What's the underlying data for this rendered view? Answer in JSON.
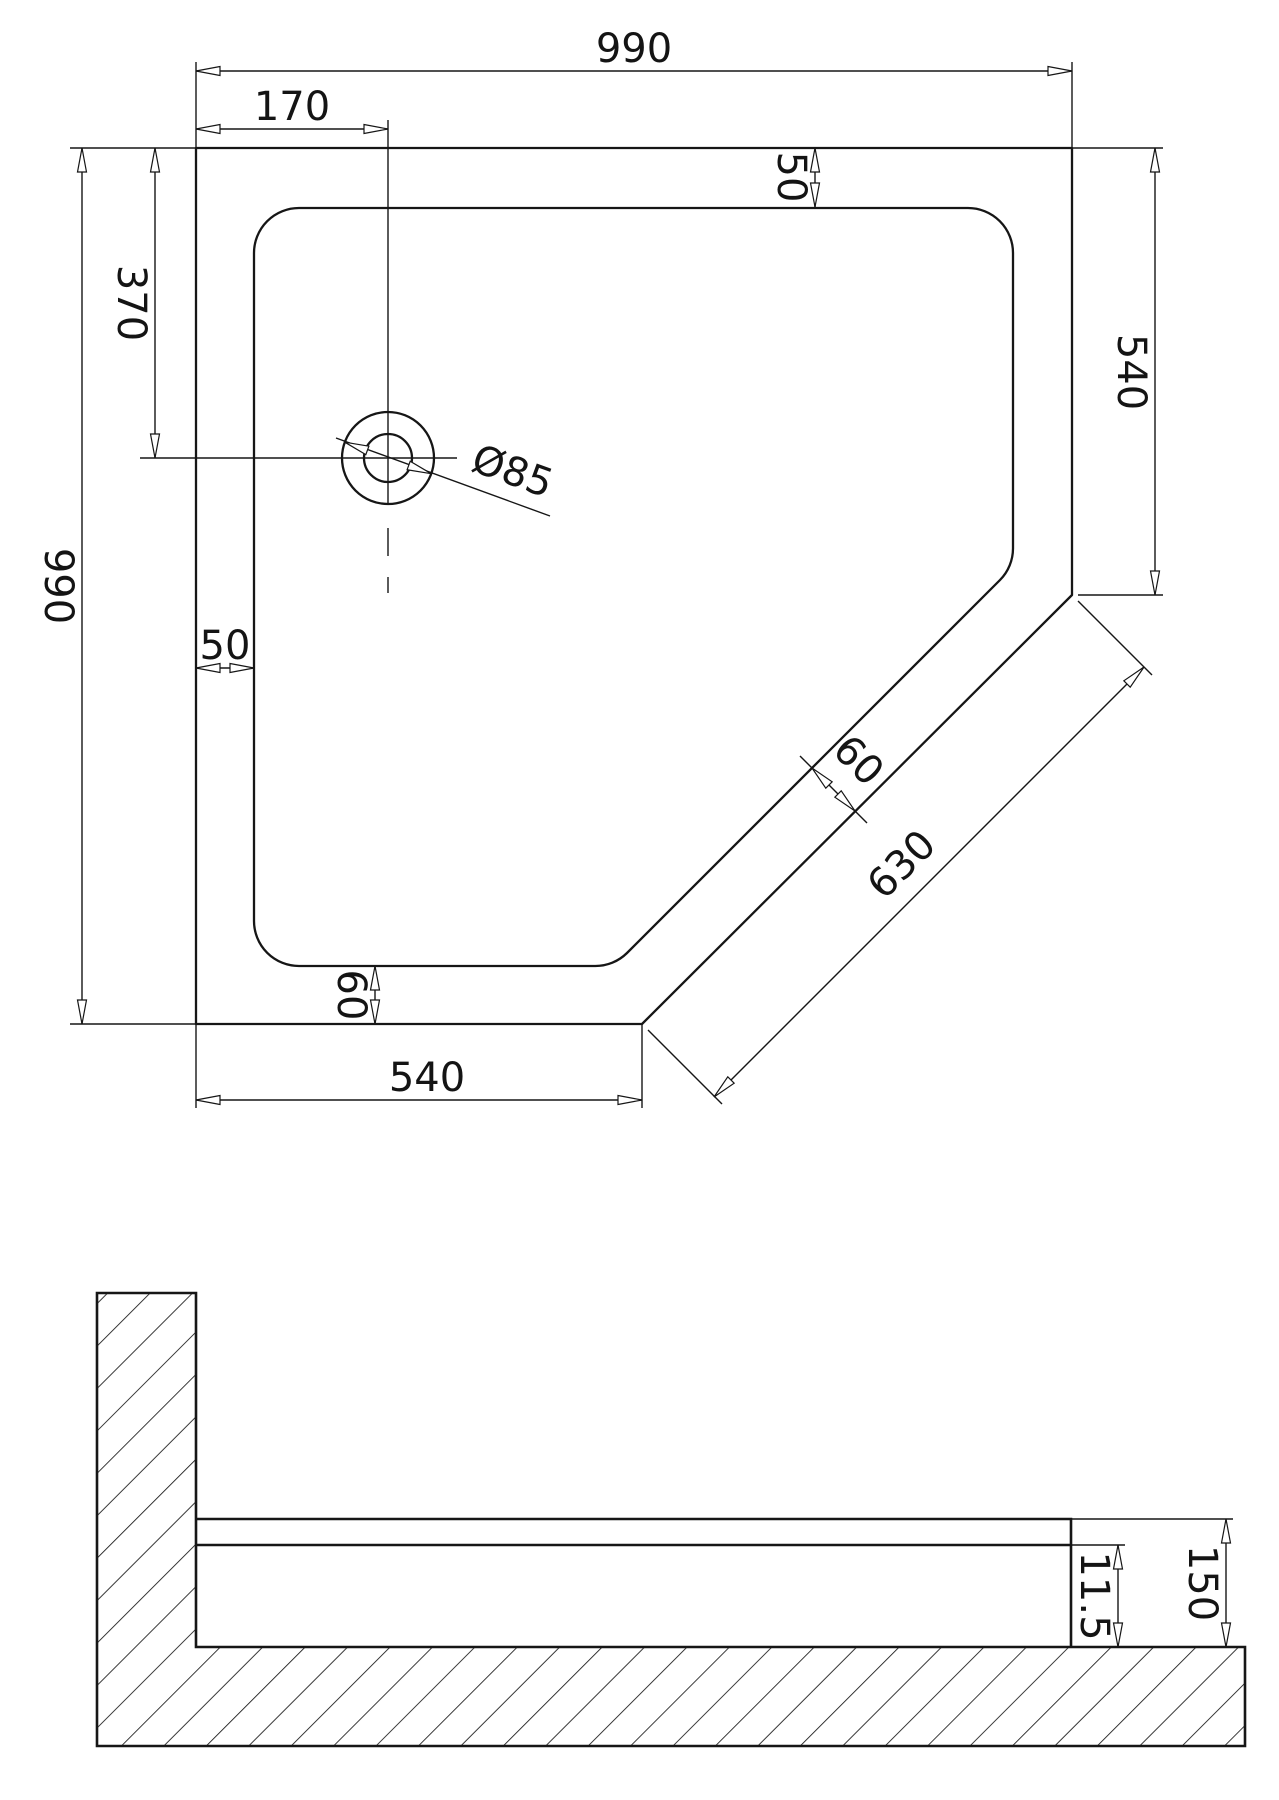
{
  "plan": {
    "dim_width_top": "990",
    "dim_drain_offset_x": "170",
    "dim_rim_top_right": "50",
    "dim_right_side": "540",
    "dim_drain_offset_y": "370",
    "dim_height_left": "990",
    "dim_rim_left": "50",
    "dim_rim_diagonal": "60",
    "dim_diagonal_edge": "630",
    "dim_rim_bottom": "60",
    "dim_bottom_edge": "540",
    "dim_drain_diameter": "Ø85"
  },
  "section": {
    "dim_inner_depth": "11.5",
    "dim_total_height": "150"
  }
}
